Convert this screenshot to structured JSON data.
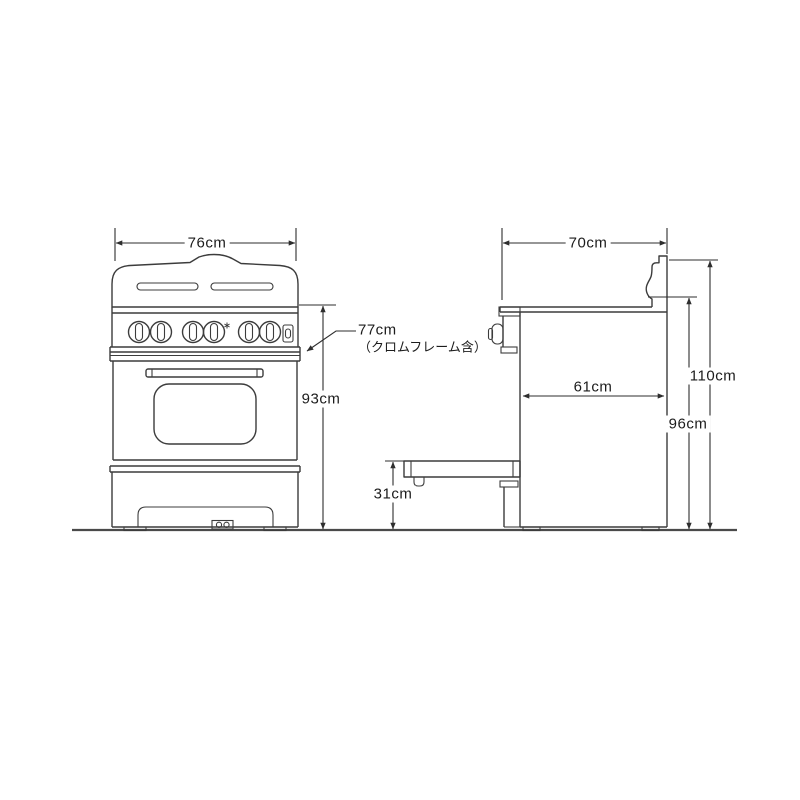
{
  "diagram": {
    "background_color": "#ffffff",
    "line_color": "#3c3c3c",
    "label_color": "#1c1c1c"
  },
  "front_view": {
    "width": "76cm",
    "overall_height": "93cm",
    "frame_height": "77cm",
    "frame_height_note": "（クロムフレーム含）"
  },
  "side_view": {
    "depth": "70cm",
    "body_depth": "61cm",
    "open_door_height": "31cm",
    "top_height": "96cm",
    "backguard_height": "110cm"
  }
}
